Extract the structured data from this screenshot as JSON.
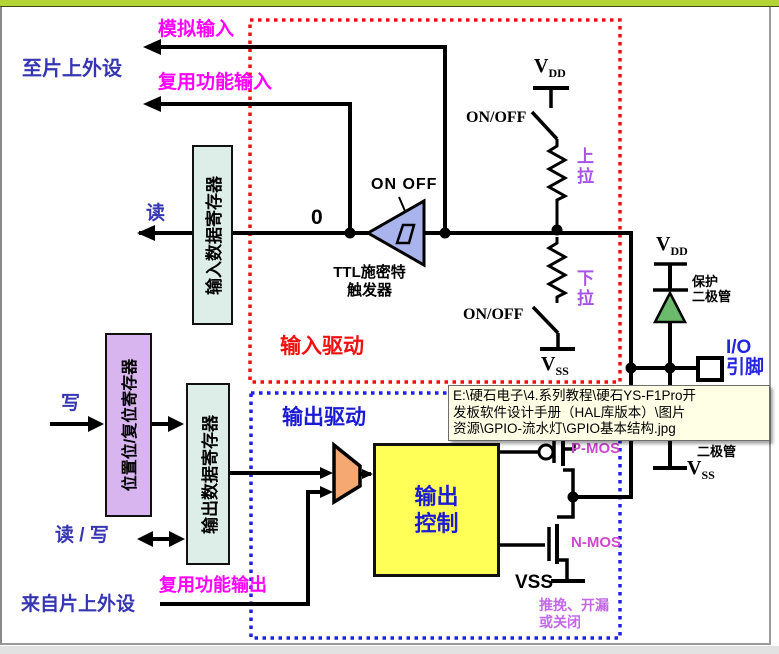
{
  "tooltip": {
    "lines": [
      "E:\\硬石电子\\4.系列教程\\硬石YS-F1Pro开",
      "发板软件设计手册（HAL库版本）\\图片",
      "资源\\GPIO-流水灯\\GPIO基本结构.jpg"
    ]
  },
  "input_section": {
    "title": "输入驱动",
    "to_peripherals": "至片上外设",
    "analog_input": "模拟输入",
    "af_input": "复用功能输入",
    "read": "读",
    "input_data_register": "输入数据寄存器",
    "zero": "0",
    "trigger_switch": "ON OFF",
    "schmitt_line1": "TTL施密特",
    "schmitt_line2": "触发器",
    "on_off_top": "ON/OFF",
    "on_off_bottom": "ON/OFF",
    "pull_up": "上拉",
    "pull_down": "下拉"
  },
  "output_section": {
    "title": "输出驱动",
    "write": "写",
    "bit_set_reset_register": "位置位/复位寄存器",
    "output_data_register": "输出数据寄存器",
    "read_write": "读 / 写",
    "from_peripherals": "来自片上外设",
    "af_output": "复用功能输出",
    "output_control_line1": "输出",
    "output_control_line2": "控制",
    "pmos": "P-MOS",
    "nmos": "N-MOS",
    "vss": "VSS",
    "mode_line1": "推挽、开漏",
    "mode_line2": "或关闭"
  },
  "pin_section": {
    "vdd_v": "V",
    "vdd_sub": "DD",
    "vss_v": "V",
    "vss_sub": "SS",
    "protection_diode_line1": "保护",
    "protection_diode_line2": "二极管",
    "diode_partial": "二极管",
    "io_pin_line1": "I/O",
    "io_pin_line2": "引脚"
  },
  "colors": {
    "top_bar": "#b3d435",
    "input_box_border": "#f01010",
    "output_box_border": "#2020e8",
    "magenta_label": "#ff00ff",
    "navy_label": "#3636b2",
    "purple_label": "#a852e8",
    "register_green": "#dceee7",
    "register_purple": "#d8b5ee",
    "control_yellow": "#ffff58",
    "mux_peach": "#f5a871",
    "trigger_blue": "#aab4ec",
    "diode_green": "#6cbb6c",
    "tooltip_bg": "#ffffe6"
  }
}
